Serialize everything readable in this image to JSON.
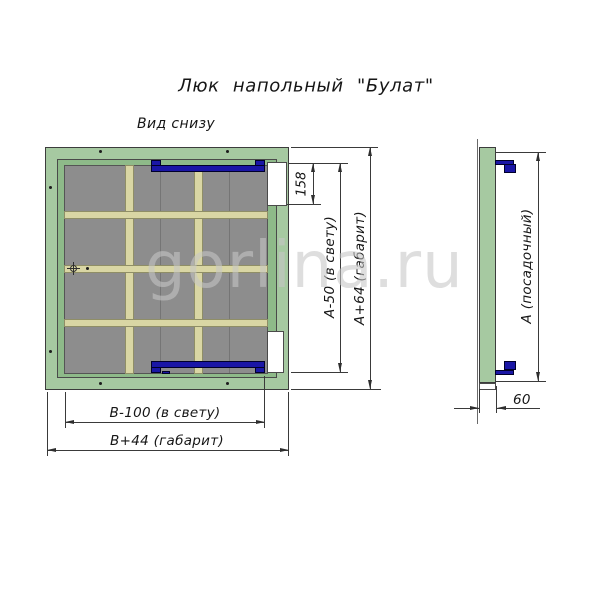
{
  "title": "Люк напольный \"Булат\"",
  "watermark": "gorlina.ru",
  "views": {
    "bottom": {
      "label": "Вид снизу",
      "dimensions": {
        "hinge_offset": "158",
        "height_clear": "А-50 (в свету)",
        "height_overall": "А+64 (габарит)",
        "width_clear": "В-100 (в свету)",
        "width_overall": "В+44 (габарит)"
      }
    },
    "side": {
      "dimensions": {
        "seat_height": "А (посадочный)",
        "depth": "60"
      }
    }
  },
  "colors": {
    "frame_green": "#a6c9a1",
    "lining_green": "#8eba89",
    "panel_gray": "#8d8d8d",
    "rib_khaki": "#d9d6a4",
    "hinge_navy": "#1a16a6",
    "dimension_line": "#2e2e2e",
    "watermark_gray": "#c7c7c7"
  }
}
